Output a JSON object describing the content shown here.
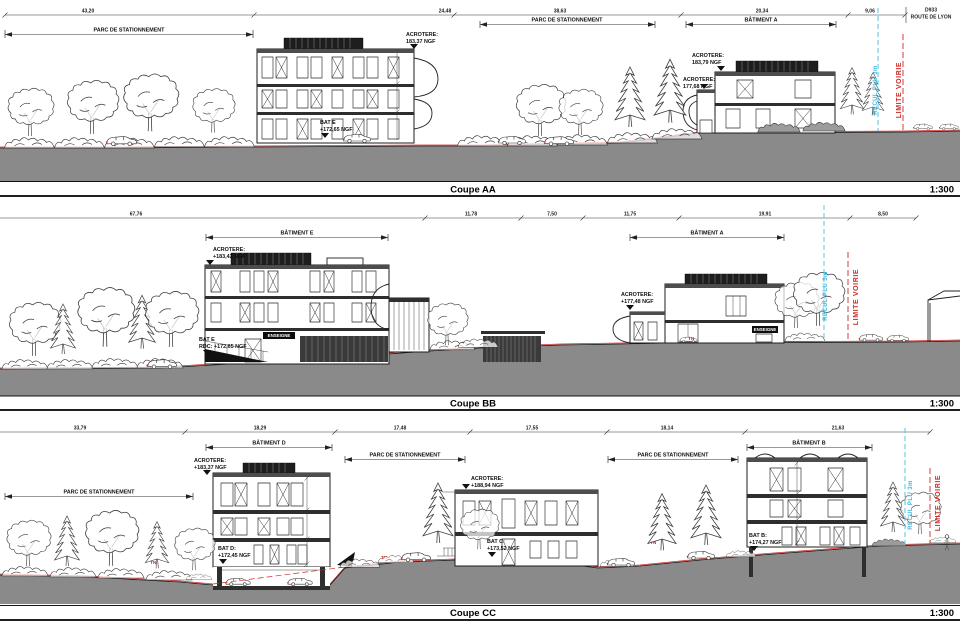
{
  "colors": {
    "accent_red": "#cf2a27",
    "accent_cyan": "#56c4e4",
    "ground_gray": "#8a8a8a"
  },
  "aa": {
    "title": "Coupe AA",
    "scale": "1:300",
    "dims": [
      "43,20",
      "24,48",
      "38,63",
      "20,34",
      "9,06"
    ],
    "road_l1": "D933",
    "road_l2": "ROUTE DE LYON",
    "parking_left": "PARC DE STATIONNEMENT",
    "parking_right": "PARC DE STATIONNEMENT",
    "batiment_a": "BÂTIMENT A",
    "acro_e_l1": "ACROTERE:",
    "acro_e_l2": "183,37 NGF",
    "bat_e_l1": "BAT E",
    "bat_e_l2": "+172,65 NGF",
    "acro_a1_l1": "ACROTERE:",
    "acro_a1_l2": "183,79 NGF",
    "acro_a2_l1": "ACROTERE:",
    "acro_a2_l2": "177,68 NGF",
    "recul": "RECUL PLU 3m",
    "limite": "LIMITE VOIRIE"
  },
  "bb": {
    "title": "Coupe BB",
    "scale": "1:300",
    "dims": [
      "67,76",
      "11,78",
      "7,50",
      "11,75",
      "19,91",
      "8,50"
    ],
    "batiment_e": "BÂTIMENT E",
    "batiment_a": "BÂTIMENT A",
    "acro_e_l1": "ACROTERE:",
    "acro_e_l2": "+183,42 NGF",
    "bat_e_l1": "BAT E",
    "bat_e_l2": "RDC: +172,65 NGF",
    "enseigne_e": "ENSEIGNE",
    "enseigne_a": "ENSEIGNE",
    "acro_a_l1": "ACROTERE:",
    "acro_a_l2": "+177,48 NGF",
    "tn": "TN",
    "recul": "RECUL PLU 3m",
    "limite": "LIMITE VOIRIE"
  },
  "cc": {
    "title": "Coupe CC",
    "scale": "1:300",
    "dims": [
      "33,79",
      "18,29",
      "17,48",
      "17,55",
      "18,14",
      "21,63"
    ],
    "batiment_d": "BÂTIMENT D",
    "batiment_b": "BÂTIMENT B",
    "parking_1": "PARC DE STATIONNEMENT",
    "parking_2": "PARC DE STATIONNEMENT",
    "parking_3": "PARC DE STATIONNEMENT",
    "acro_d_l1": "ACROTERE:",
    "acro_d_l2": "+183,37 NGF",
    "bat_d_l1": "BAT D:",
    "bat_d_l2": "+172,45 NGF",
    "acro_c_l1": "ACROTERE:",
    "acro_c_l2": "+188,94 NGF",
    "bat_c_l1": "BAT C:",
    "bat_c_l2": "+173,52 NGF",
    "bat_b_l1": "BAT B:",
    "bat_b_l2": "+174,27 NGF",
    "tn1": "TN",
    "tn2": "TN",
    "tn3": "TN",
    "recul": "RECUL PLU 3m",
    "limite": "LIMITE VOIRIE"
  }
}
